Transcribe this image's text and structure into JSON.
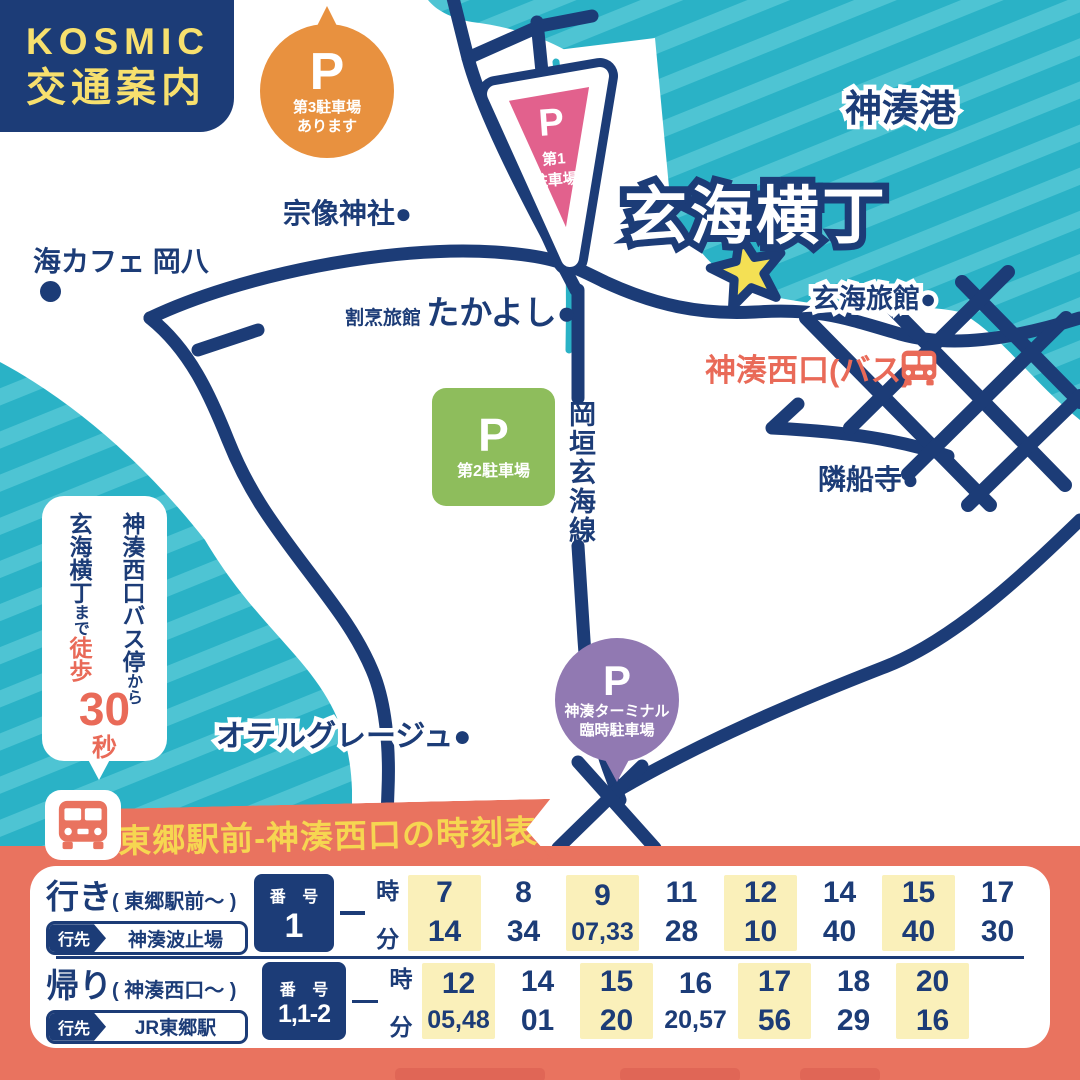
{
  "header": {
    "brand": "KOSMIC",
    "title": "交通案内"
  },
  "map": {
    "port_label": "神湊港",
    "destination_title": "玄海横丁",
    "landmarks": {
      "shrine": "宗像神社●",
      "sea_cafe": "海カフェ 岡八",
      "ryokan_prefix": "割烹旅館",
      "ryokan_name": "たかよし●",
      "genkai_ryokan": "玄海旅館●",
      "bus_stop": "神湊西口(バス)",
      "temple": "隣船寺●",
      "hotel": "オテルグレージュ●",
      "road_name": "岡垣玄海線"
    },
    "parkings": {
      "p3": {
        "symbol": "P",
        "line1": "第3駐車場",
        "line2": "あります"
      },
      "p1": {
        "symbol": "P",
        "line1": "第1",
        "line2": "駐車場"
      },
      "p2": {
        "symbol": "P",
        "line1": "第2駐車場"
      },
      "terminal": {
        "symbol": "P",
        "line1": "神湊ターミナル",
        "line2": "臨時駐車場"
      }
    },
    "walk_bubble": {
      "col_right_main": "神湊西口バス停",
      "col_right_small": "から",
      "col_left_main": "玄海横丁",
      "col_left_small": "まで",
      "walk": "徒歩",
      "number": "30",
      "unit": "秒"
    }
  },
  "timetable": {
    "title": "東郷駅前-神湊西口の時刻表",
    "rows": [
      {
        "direction": "行き",
        "from": "( 東郷駅前〜 )",
        "dest_label": "行先",
        "dest": "神湊波止場",
        "number_label": "番 号",
        "number": "1",
        "hour_label": "時",
        "minute_label": "分",
        "columns": [
          {
            "hour": "7",
            "minutes": "14",
            "highlight": true
          },
          {
            "hour": "8",
            "minutes": "34",
            "highlight": false
          },
          {
            "hour": "9",
            "minutes": "07,33",
            "highlight": true
          },
          {
            "hour": "11",
            "minutes": "28",
            "highlight": false
          },
          {
            "hour": "12",
            "minutes": "10",
            "highlight": true
          },
          {
            "hour": "14",
            "minutes": "40",
            "highlight": false
          },
          {
            "hour": "15",
            "minutes": "40",
            "highlight": true
          },
          {
            "hour": "17",
            "minutes": "30",
            "highlight": false
          }
        ]
      },
      {
        "direction": "帰り",
        "from": "( 神湊西口〜 )",
        "dest_label": "行先",
        "dest": "JR東郷駅",
        "number_label": "番 号",
        "number": "1,1-2",
        "hour_label": "時",
        "minute_label": "分",
        "columns": [
          {
            "hour": "12",
            "minutes": "05,48",
            "highlight": true
          },
          {
            "hour": "14",
            "minutes": "01",
            "highlight": false
          },
          {
            "hour": "15",
            "minutes": "20",
            "highlight": true
          },
          {
            "hour": "16",
            "minutes": "20,57",
            "highlight": false
          },
          {
            "hour": "17",
            "minutes": "56",
            "highlight": true
          },
          {
            "hour": "18",
            "minutes": "29",
            "highlight": false
          },
          {
            "hour": "20",
            "minutes": "16",
            "highlight": true
          }
        ]
      }
    ]
  },
  "colors": {
    "navy": "#1c3c77",
    "teal": "#2ab2c6",
    "teal_stripe": "#4ec4d3",
    "coral": "#e9735f",
    "banner_yellow": "#f6d651",
    "kosmic_yellow": "#f7e06e",
    "orange": "#e8913f",
    "pink": "#e2618d",
    "green": "#8ebd5c",
    "purple": "#9179b2",
    "star_yellow": "#f4e054",
    "cell_yellow": "#faf0ba"
  }
}
